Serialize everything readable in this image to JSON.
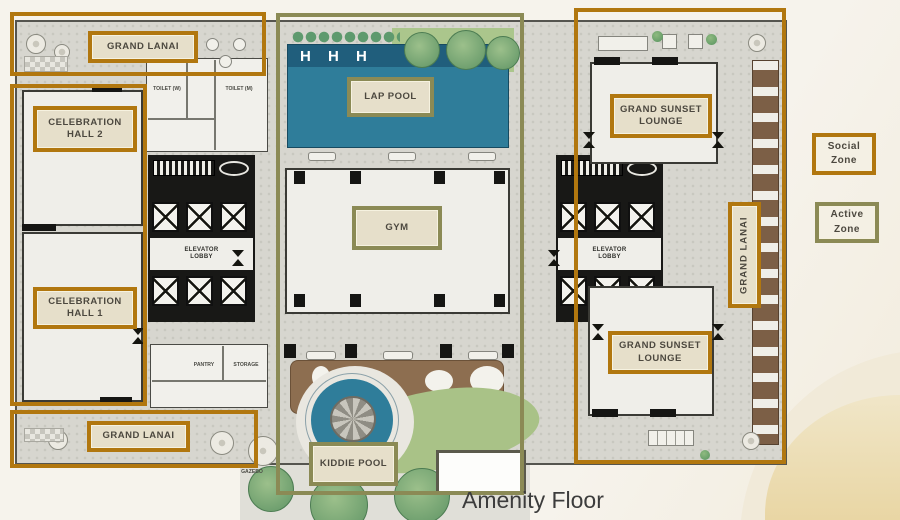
{
  "page": {
    "title": "Amenity Floor",
    "background": "#f4f1e9",
    "sand_color": "#ecdbae"
  },
  "legend": {
    "social": {
      "label": "Social Zone",
      "color": "#b1770f"
    },
    "active": {
      "label": "Active Zone",
      "color": "#8b8a55"
    }
  },
  "zones": {
    "social": {
      "color": "#b1770f",
      "areas": {
        "grand_lanai_top": {
          "label": "GRAND LANAI"
        },
        "celebration_hall_2": {
          "label": "CELEBRATION HALL 2"
        },
        "celebration_hall_1": {
          "label": "CELEBRATION HALL 1"
        },
        "grand_lanai_bottom": {
          "label": "GRAND LANAI"
        },
        "grand_sunset_lounge_top": {
          "label": "GRAND SUNSET LOUNGE"
        },
        "grand_sunset_lounge_bottom": {
          "label": "GRAND SUNSET LOUNGE"
        },
        "grand_lanai_right": {
          "label": "GRAND LANAI"
        }
      }
    },
    "active": {
      "color": "#8b8a55",
      "areas": {
        "lap_pool": {
          "label": "LAP POOL"
        },
        "gym": {
          "label": "GYM"
        },
        "kiddie_pool": {
          "label": "KIDDIE POOL"
        }
      }
    }
  },
  "plan_text": {
    "elevator_lobby_left": "ELEVATOR LOBBY",
    "elevator_lobby_right": "ELEVATOR LOBBY",
    "toilet_w": "TOILET (W)",
    "toilet_m": "TOILET (M)",
    "pantry": "PANTRY",
    "storage": "STORAGE",
    "gazebo": "GAZEBO",
    "pool_lane_markers": "H H H"
  },
  "colors": {
    "pool_water": "#2f7d9a",
    "pool_deep": "#205e7c",
    "deck_wood": "#8d6e50",
    "lawn": "#a9c287",
    "walls": "#181816",
    "paving": "#d7d6cf",
    "room": "#efeee9"
  }
}
